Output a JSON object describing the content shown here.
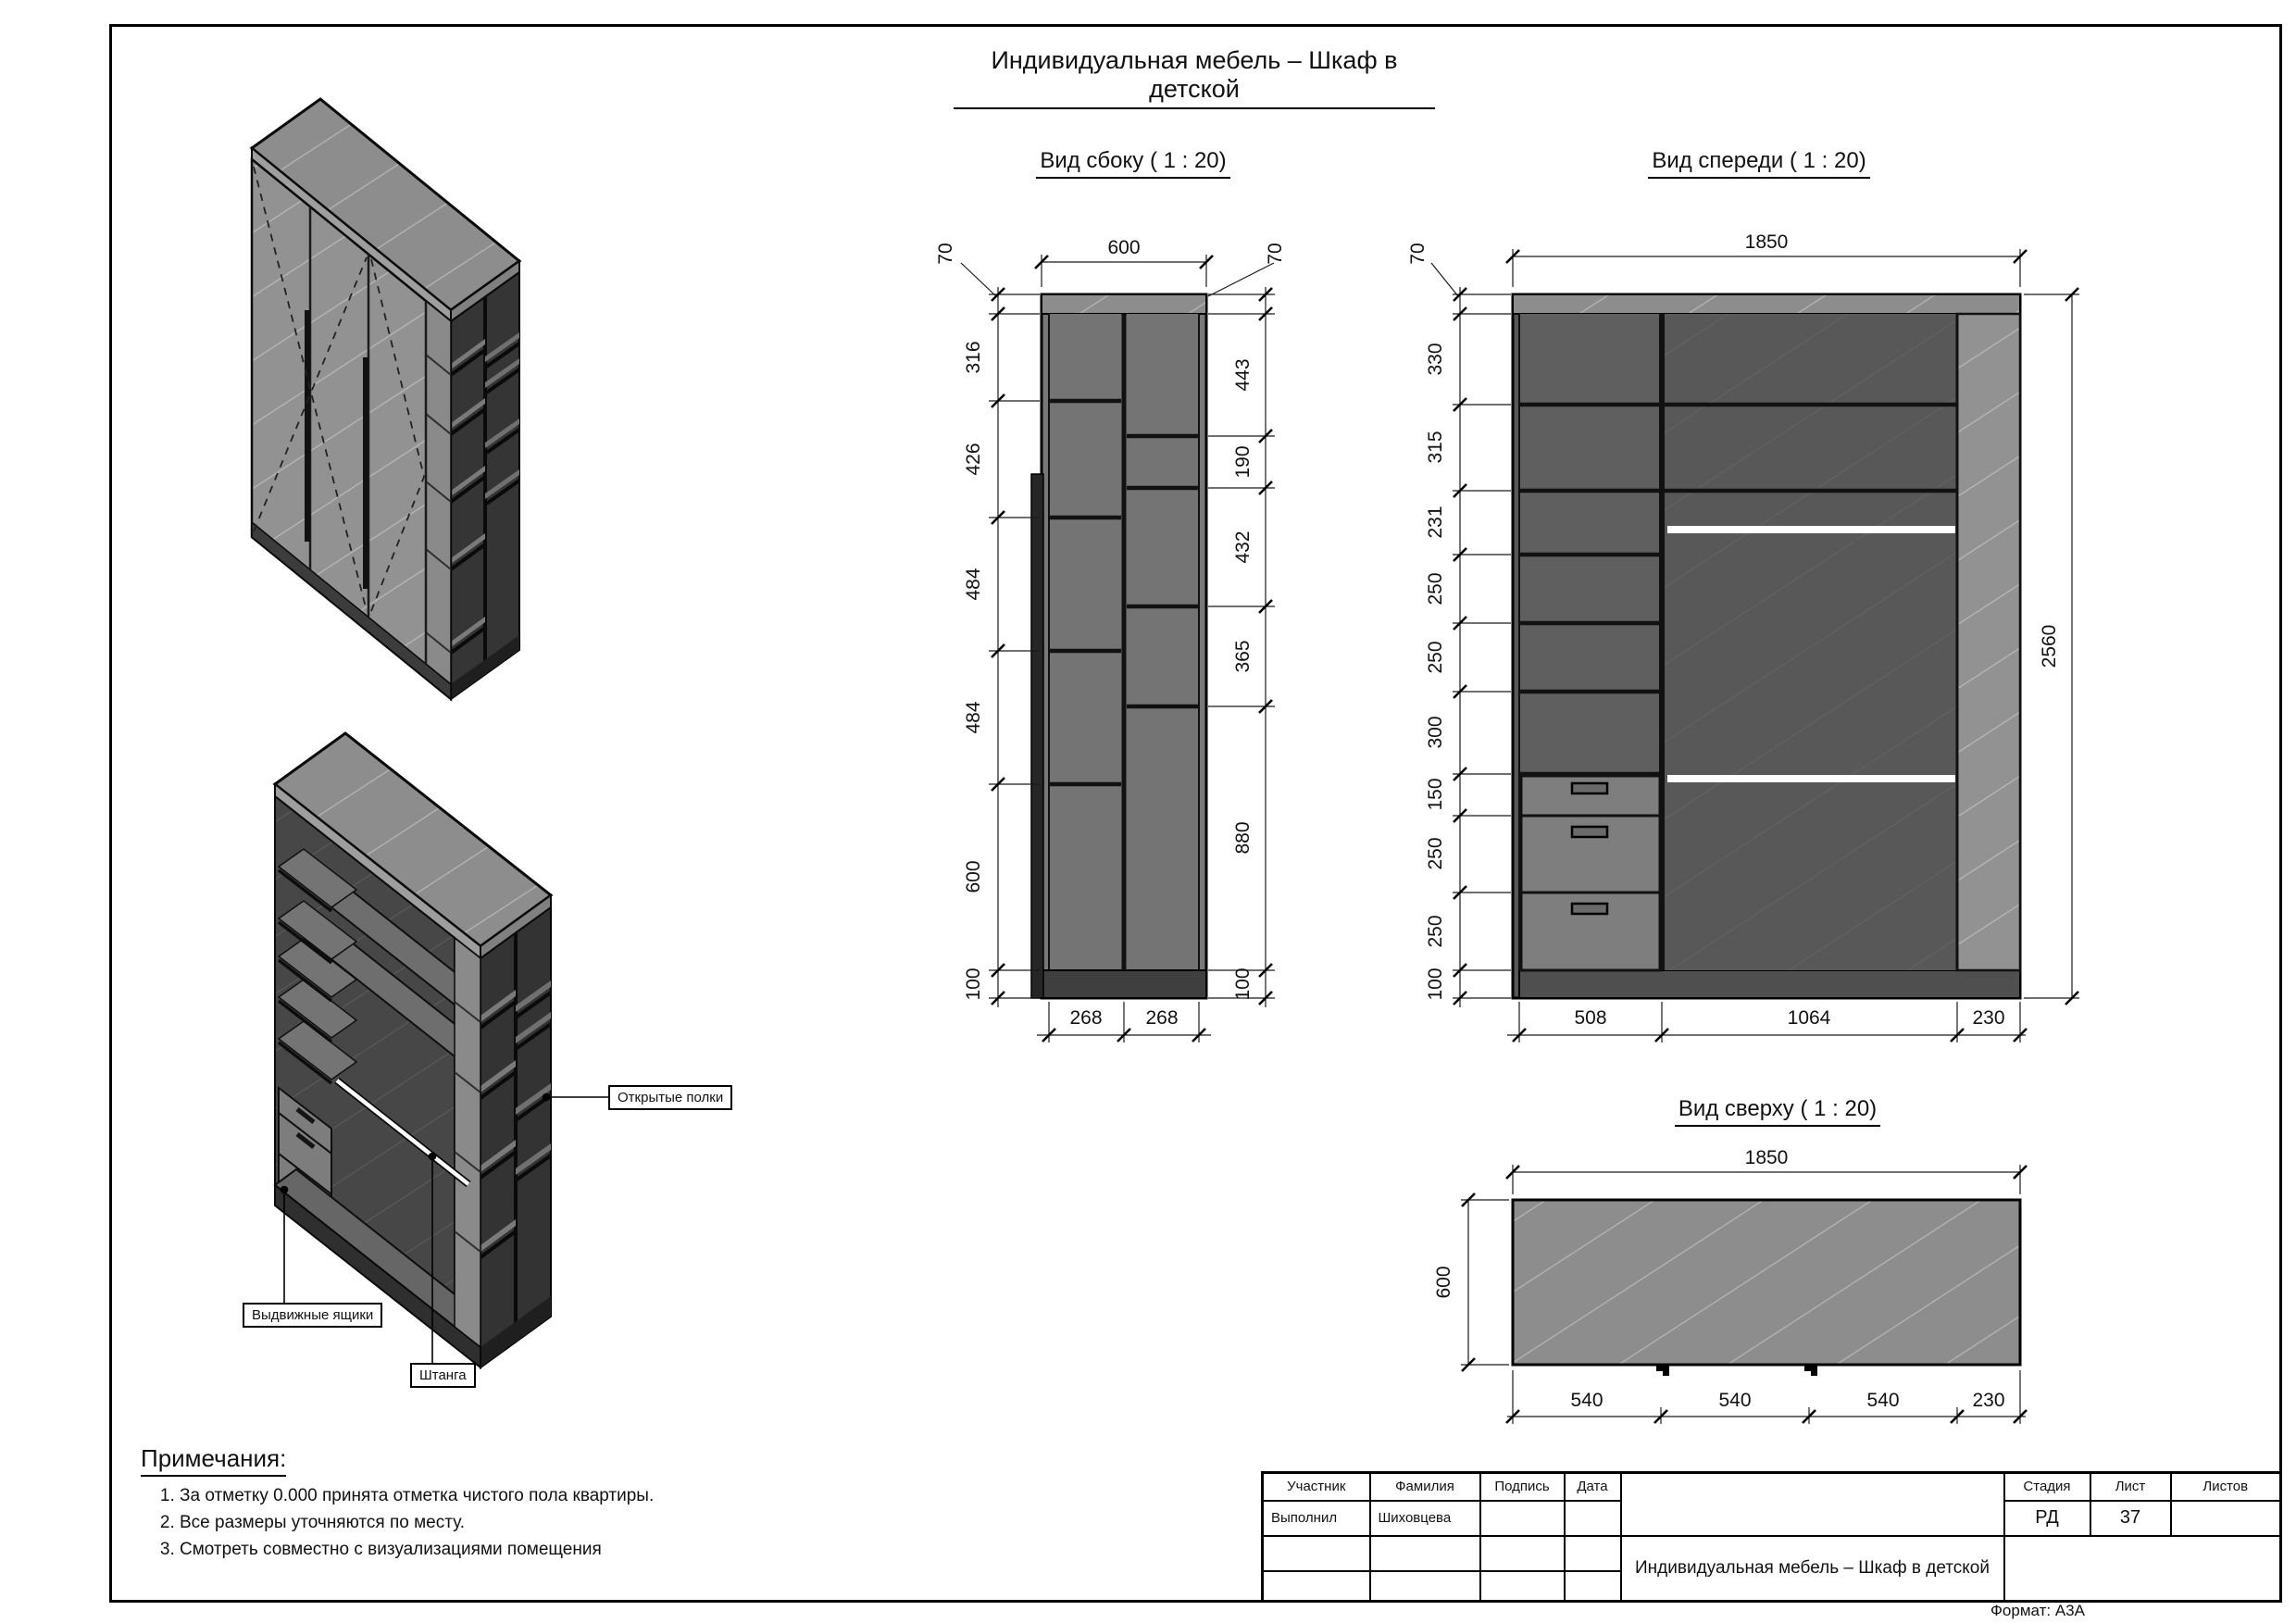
{
  "page": {
    "title": "Индивидуальная мебель – Шкаф в детской",
    "format": "Формат: А3А"
  },
  "side_view": {
    "title": "Вид сбоку ( 1 : 20)",
    "top": "600",
    "edge_left": "70",
    "edge_right": "70",
    "left": [
      "316",
      "426",
      "484",
      "484",
      "600",
      "100"
    ],
    "right": [
      "443",
      "190",
      "432",
      "365",
      "880",
      "100"
    ],
    "bottom": [
      "268",
      "268"
    ]
  },
  "front_view": {
    "title": "Вид спереди ( 1 : 20)",
    "top": "1850",
    "edge": "70",
    "height": "2560",
    "left": [
      "330",
      "315",
      "231",
      "250",
      "250",
      "300",
      "150",
      "250",
      "250",
      "100"
    ],
    "bottom": [
      "508",
      "1064",
      "230"
    ]
  },
  "top_view": {
    "title": "Вид сверху ( 1 : 20)",
    "top": "1850",
    "side": "600",
    "bottom": [
      "540",
      "540",
      "540",
      "230"
    ]
  },
  "callouts": {
    "shelves": "Открытые полки",
    "drawers": "Выдвижные ящики",
    "rod": "Штанга"
  },
  "notes": {
    "title": "Примечания:",
    "items": [
      "За отметку 0.000 принята отметка чистого пола квартиры.",
      "Все размеры уточняются по месту.",
      "Смотреть совместно с визуализациями помещения"
    ]
  },
  "title_block": {
    "col_participant": "Участник",
    "col_surname": "Фамилия",
    "col_signature": "Подпись",
    "col_date": "Дата",
    "col_stage": "Стадия",
    "col_sheet": "Лист",
    "col_sheets": "Листов",
    "row_role": "Выполнил",
    "row_surname": "Шиховцева",
    "stage": "РД",
    "sheet": "37",
    "project": "Индивидуальная мебель – Шкаф в детской"
  },
  "colors": {
    "line": "#111111",
    "panel_light": "#929292",
    "panel_mid": "#6f6f6f",
    "panel_dark": "#575757",
    "interior": "#3a3a3a",
    "drawer": "#7d7d7d",
    "plinth": "#3f3f3f",
    "rod": "#ffffff"
  }
}
